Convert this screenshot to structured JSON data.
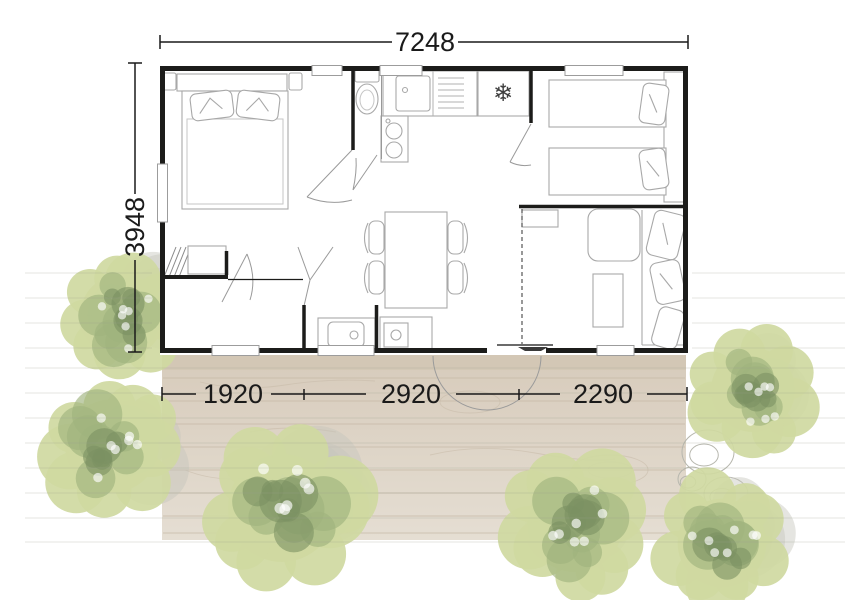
{
  "dimensions": {
    "top_width": "7248",
    "left_height": "3948",
    "bottom_segments": [
      "1920",
      "2920",
      "2290"
    ]
  },
  "icons": {
    "freezer_snowflake": "❄"
  },
  "colors": {
    "wall": "#1c1c1a",
    "dimension": "#1a1a1a",
    "furniture": "#a8a8a8",
    "deck_top": "#d7cbbb",
    "deck_bottom": "#e5ded3",
    "deck_line": "#c6b9a7",
    "tree_base": "#cfd9a1",
    "tree_mid": "#9fb37e",
    "tree_dark": "#7c9162",
    "tree_shadow": "#c6c5bd",
    "ground_line": "#9aa08e"
  },
  "scene": {
    "trees": [
      {
        "cx": 122,
        "cy": 316,
        "r": 70
      },
      {
        "cx": 112,
        "cy": 446,
        "r": 78
      },
      {
        "cx": 282,
        "cy": 508,
        "r": 90
      },
      {
        "cx": 575,
        "cy": 524,
        "r": 80
      },
      {
        "cx": 753,
        "cy": 390,
        "r": 70
      },
      {
        "cx": 722,
        "cy": 543,
        "r": 74
      }
    ],
    "bushes": [
      {
        "cx": 708,
        "cy": 452,
        "rx": 26,
        "ry": 22
      },
      {
        "cx": 726,
        "cy": 494,
        "rx": 22,
        "ry": 17
      },
      {
        "cx": 692,
        "cy": 479,
        "rx": 14,
        "ry": 12
      }
    ]
  }
}
